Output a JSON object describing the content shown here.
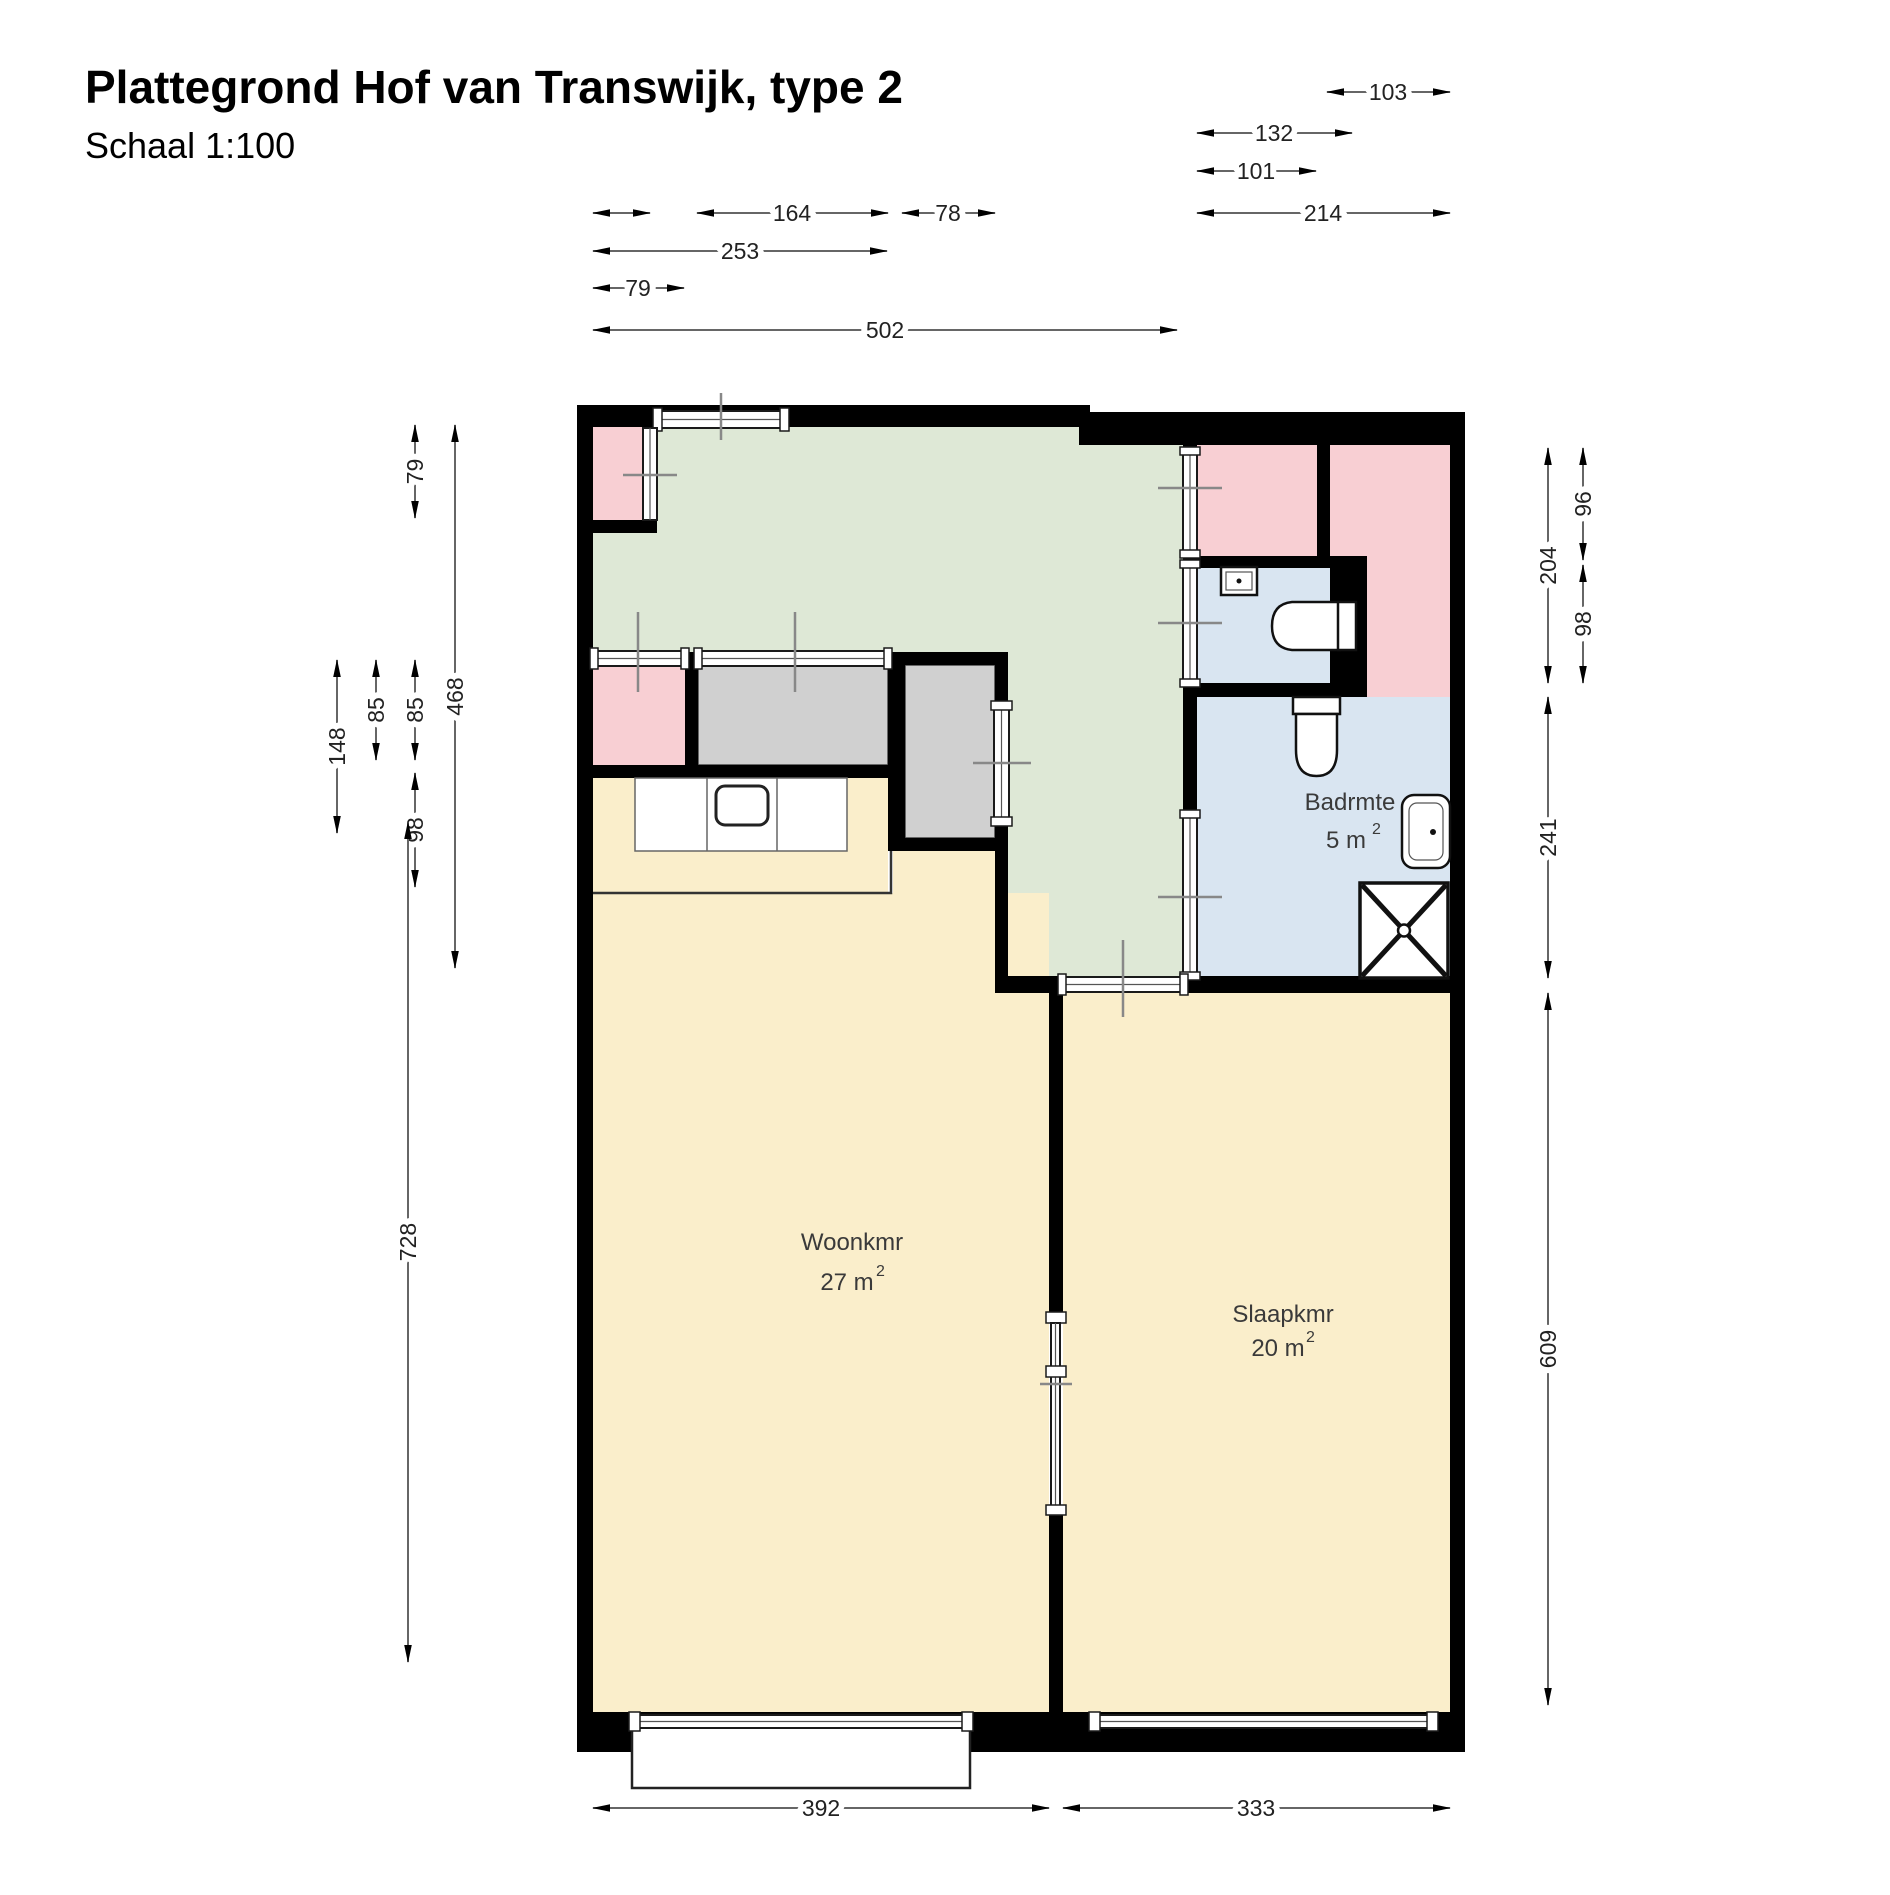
{
  "title": "Plattegrond Hof van Transwijk, type 2",
  "subtitle": "Schaal 1:100",
  "palette": {
    "wall": "#000000",
    "hall": "#dee8d6",
    "closet_room": "#f8cfd3",
    "bathroom_floor": "#d9e5f1",
    "living_floor": "#faeecb",
    "cabinet": "#d0d0d0"
  },
  "rooms": {
    "living": {
      "name": "Woonkmr",
      "area": "27 m",
      "area_exp": "2"
    },
    "bedroom": {
      "name": "Slaapkmr",
      "area": "20 m",
      "area_exp": "2"
    },
    "bathroom": {
      "name": "Badrmte",
      "area": "5 m",
      "area_exp": "2"
    }
  },
  "dims": {
    "t103": "103",
    "t132": "132",
    "t101": "101",
    "t164": "164",
    "t78": "78",
    "t214": "214",
    "t253": "253",
    "t79": "79",
    "t502": "502",
    "l79": "79",
    "l468": "468",
    "l148": "148",
    "l85a": "85",
    "l85b": "85",
    "l98": "98",
    "l728": "728",
    "r96": "96",
    "r204": "204",
    "r98": "98",
    "r241": "241",
    "r609": "609",
    "b392": "392",
    "b333": "333"
  }
}
